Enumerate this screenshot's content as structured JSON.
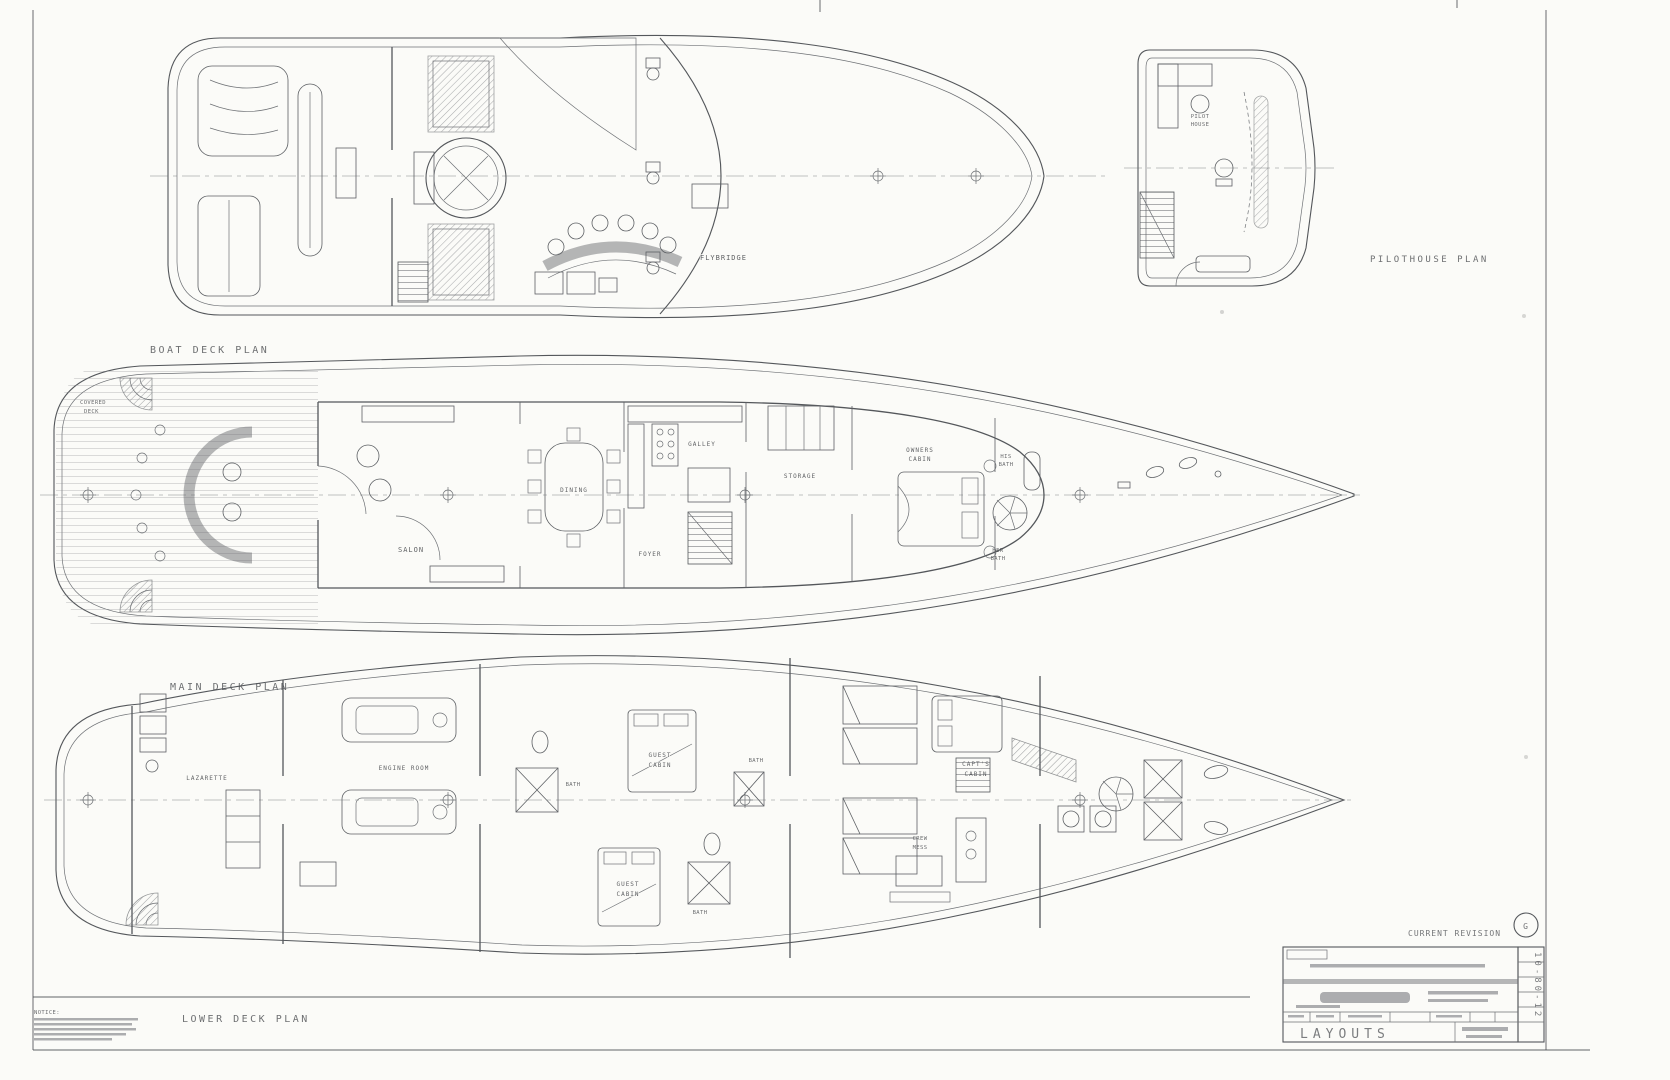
{
  "colors": {
    "paper": "#fbfbf8",
    "ink": "#54575b"
  },
  "plan_titles": {
    "boat_deck": "BOAT DECK PLAN",
    "pilothouse": "PILOTHOUSE PLAN",
    "main_deck": "MAIN DECK PLAN",
    "lower_deck": "LOWER DECK PLAN"
  },
  "boat_deck": {
    "flybridge": "FLYBRIDGE"
  },
  "pilothouse": {
    "line1": "PILOT",
    "line2": "HOUSE"
  },
  "main_deck": {
    "covered1": "COVERED",
    "covered2": "DECK",
    "salon": "SALON",
    "dining": "DINING",
    "galley": "GALLEY",
    "foyer": "FOYER",
    "storage": "STORAGE",
    "owners1": "OWNERS",
    "owners2": "CABIN",
    "his1": "HIS",
    "his2": "BATH",
    "her1": "HER",
    "her2": "BATH"
  },
  "lower_deck": {
    "lazarette": "LAZARETTE",
    "engine_room": "ENGINE ROOM",
    "guest_fwd1": "GUEST",
    "guest_fwd2": "CABIN",
    "guest_aft1": "GUEST",
    "guest_aft2": "CABIN",
    "capts1": "CAPT'S",
    "capts2": "CABIN",
    "crew1": "CREW",
    "crew2": "MESS",
    "bath1": "BATH",
    "bath2": "BATH",
    "bath3": "BATH"
  },
  "title_block": {
    "current_revision": "CURRENT REVISION",
    "revision_letter": "G",
    "sheet_title": "LAYOUTS",
    "drawing_number": "10-80-12",
    "notice": "NOTICE:"
  }
}
